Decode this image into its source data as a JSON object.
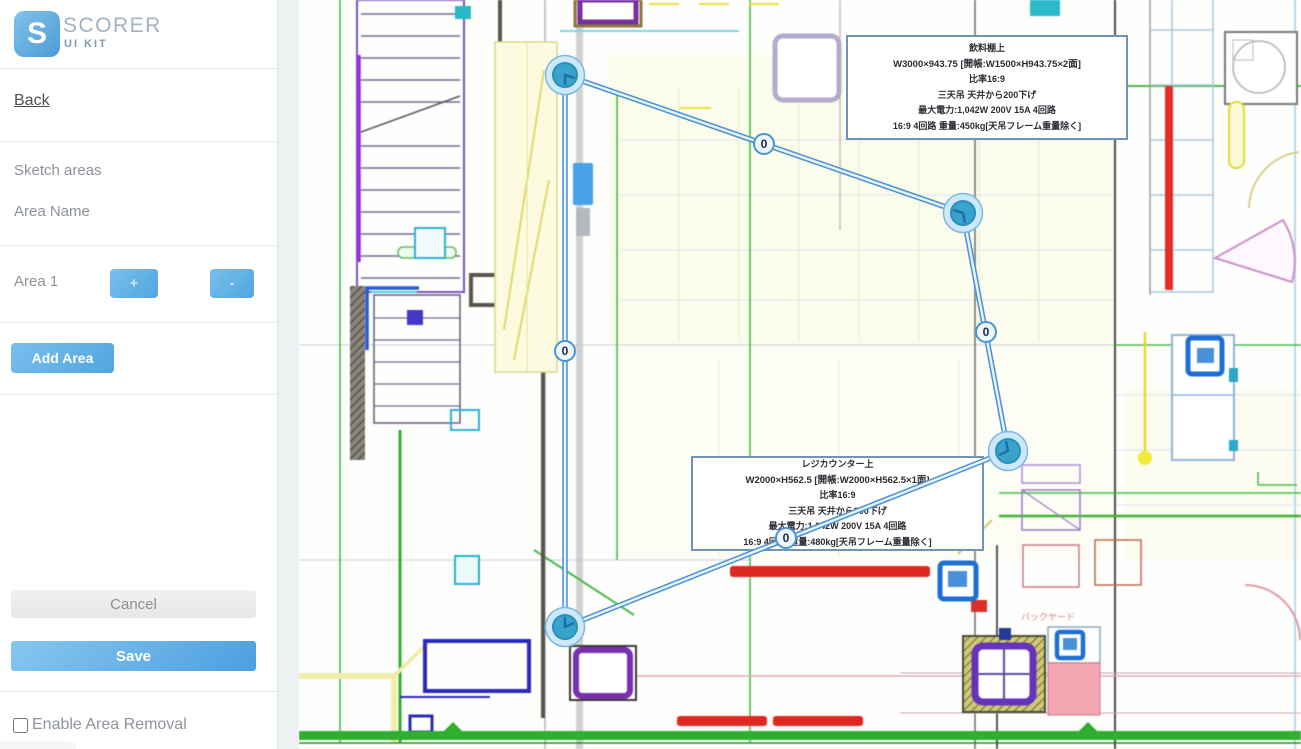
{
  "sidebar": {
    "logo": {
      "letter": "S",
      "title": "SCORER",
      "subtitle": "UI KIT"
    },
    "back_label": "Back",
    "sketch_areas_label": "Sketch areas",
    "area_name_label": "Area Name",
    "areas": [
      {
        "name": "Area 1",
        "increment_label": "+",
        "decrement_label": "-"
      }
    ],
    "add_area_label": "Add Area",
    "cancel_label": "Cancel",
    "save_label": "Save",
    "enable_area_removal_label": "Enable Area Removal",
    "enable_area_removal_checked": false
  },
  "canvas": {
    "edge_labels": [
      "0",
      "0",
      "0",
      "0"
    ],
    "annotations": [
      {
        "lines": [
          "飲料棚上",
          "W3000×943.75 [開帳:W1500×H943.75×2面]",
          "比率16:9",
          "三天吊 天井から200下げ",
          "最大電力:1,042W 200V 15A 4回路",
          "16:9 4回路 重量:450kg[天吊フレーム重量除く]"
        ]
      },
      {
        "lines": [
          "レジカウンター上",
          "W2000×H562.5 [開帳:W2000×H562.5×1面]",
          "比率16:9",
          "三天吊 天井から800下げ",
          "最大電力:1,042W 200V 15A 4回路",
          "16:9 4回路 重量:480kg[天吊フレーム重量除く]"
        ]
      }
    ],
    "plan_labels": {
      "backyard": "バックヤード"
    }
  },
  "colors": {
    "accent": "#58a9e3",
    "polygon_stroke": "#4a94d6",
    "polygon_inner": "#eaf4fb",
    "vertex_outer": "#cde8f8",
    "vertex_inner": "#38a3cb",
    "save_gradient_start": "#86c7ef",
    "save_gradient_end": "#4d9fe0"
  }
}
